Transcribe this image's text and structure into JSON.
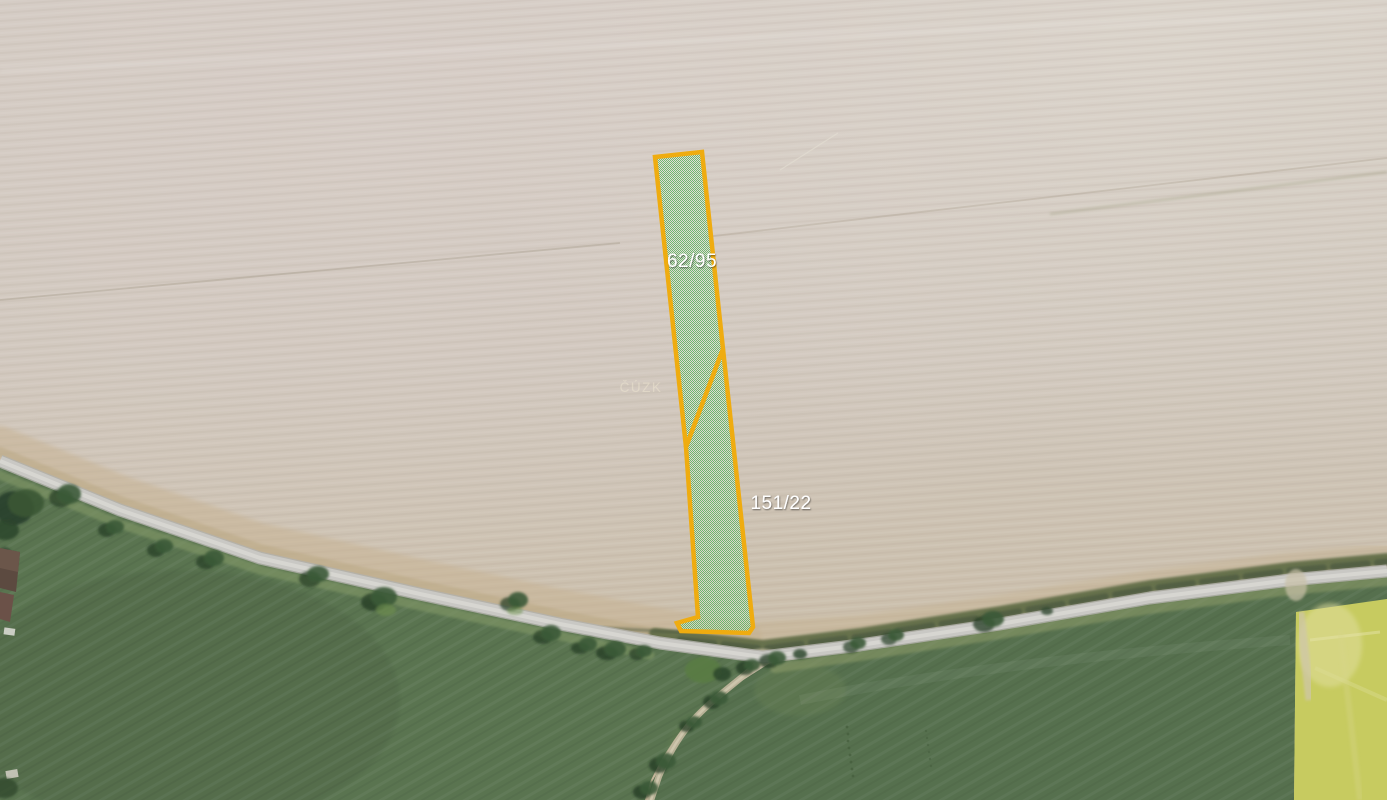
{
  "map": {
    "watermark": "ČÚZK",
    "parcels": [
      {
        "label": "62/95"
      },
      {
        "label": "151/22"
      }
    ],
    "colors": {
      "parcel_border": "#EFAC10",
      "parcel_fill_dot": "#5AAF5F",
      "parcel_label": "#FFFFFF",
      "field_bare": "#D0C7BC",
      "field_grass_left": "#5A7450",
      "field_grass_right": "#56704E",
      "field_rapeseed": "#C7CB60",
      "road": "#C9C8C4"
    }
  }
}
